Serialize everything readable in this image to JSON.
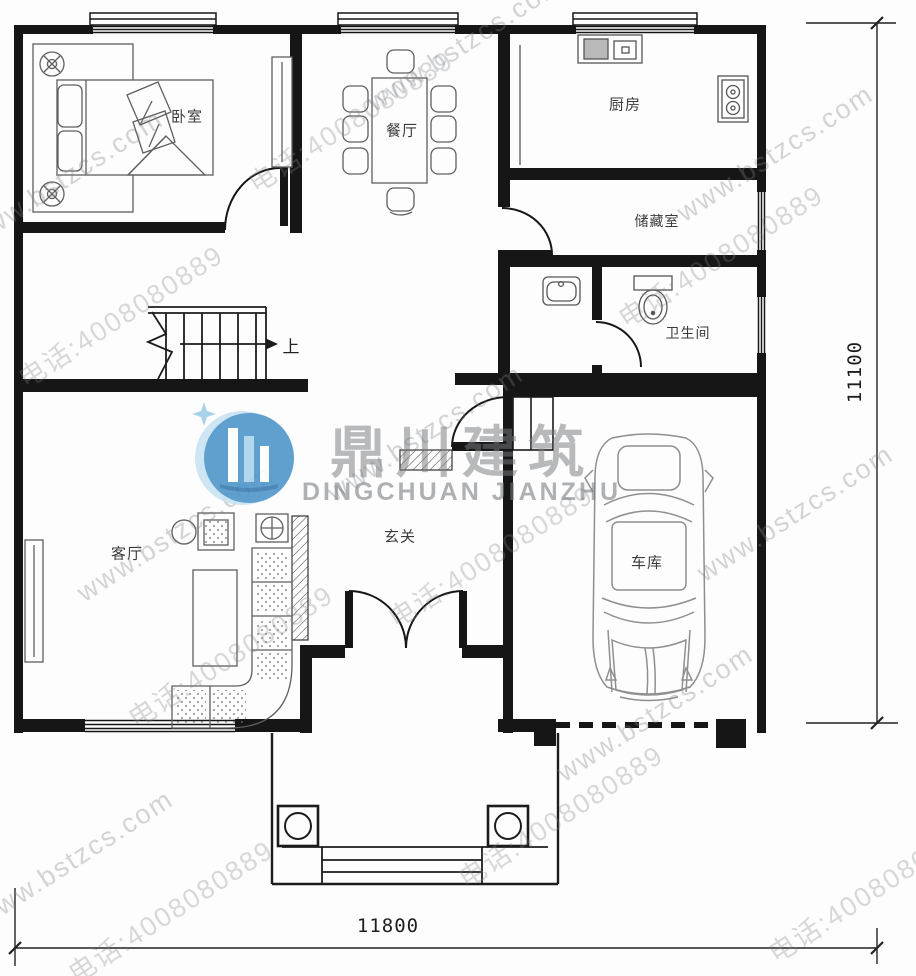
{
  "watermark": {
    "site": "www.bstzcs.com",
    "phone": "电话:4008080889"
  },
  "logo": {
    "name_cn": "鼎川建筑",
    "name_en": "DINGCHUAN JIANZHU"
  },
  "rooms": {
    "bedroom": "卧室",
    "dining": "餐厅",
    "kitchen": "厨房",
    "storage": "储藏室",
    "bathroom": "卫生间",
    "living": "客厅",
    "foyer": "玄关",
    "garage": "车库"
  },
  "stairs": {
    "up": "上"
  },
  "dimensions": {
    "width": "11800",
    "height": "11100"
  }
}
